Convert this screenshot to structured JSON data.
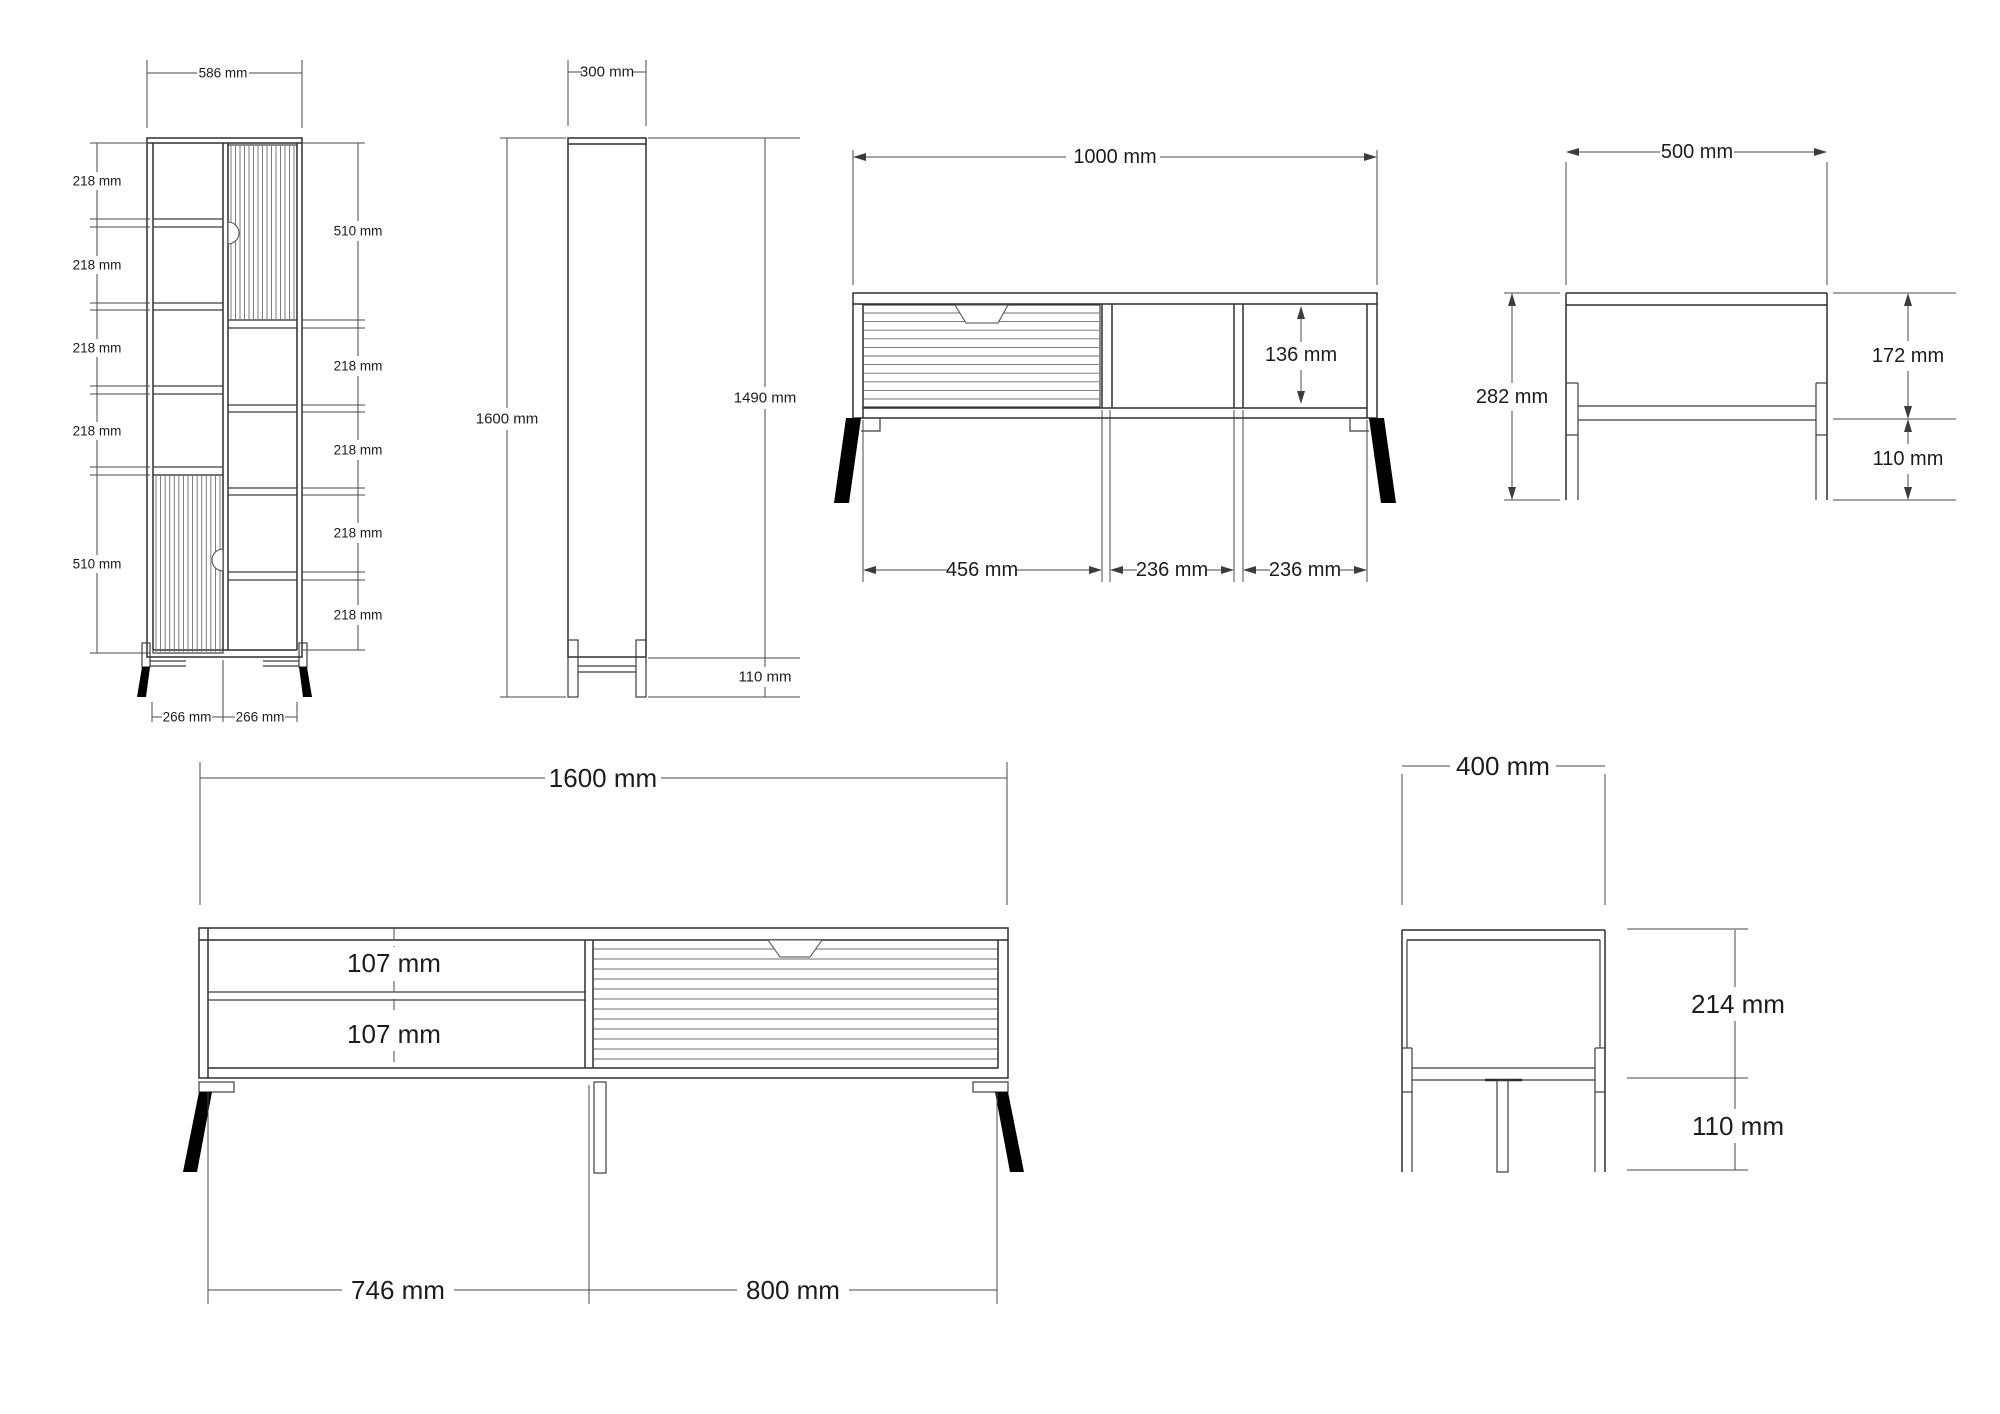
{
  "drawing": {
    "unit": "mm",
    "line_color": "#3c3c3c",
    "text_color": "#1c1c1c",
    "views": {
      "cabinet_front": {
        "top_width": "586 mm",
        "left_dims": [
          "218 mm",
          "218 mm",
          "218 mm",
          "218 mm",
          "510 mm"
        ],
        "right_dims": [
          "510 mm",
          "218 mm",
          "218 mm",
          "218 mm",
          "218 mm"
        ],
        "bottom_dims": [
          "266 mm",
          "266 mm"
        ]
      },
      "cabinet_side": {
        "top_width": "300 mm",
        "total_height": "1600 mm",
        "body_height": "1490 mm",
        "leg_height": "110 mm"
      },
      "tv_stand_1000_front": {
        "top_width": "1000 mm",
        "opening_height": "136 mm",
        "bottom_dims": [
          "456 mm",
          "236 mm",
          "236 mm"
        ]
      },
      "tv_stand_1000_side": {
        "top_width": "500 mm",
        "total_height": "282 mm",
        "body_height": "172 mm",
        "leg_height": "110 mm"
      },
      "tv_stand_1600_front": {
        "top_width": "1600 mm",
        "shelf_dims": [
          "107 mm",
          "107 mm"
        ],
        "bottom_dims": [
          "746 mm",
          "800 mm"
        ]
      },
      "tv_stand_1600_side": {
        "top_width": "400 mm",
        "body_height": "214 mm",
        "leg_height": "110 mm"
      }
    }
  }
}
